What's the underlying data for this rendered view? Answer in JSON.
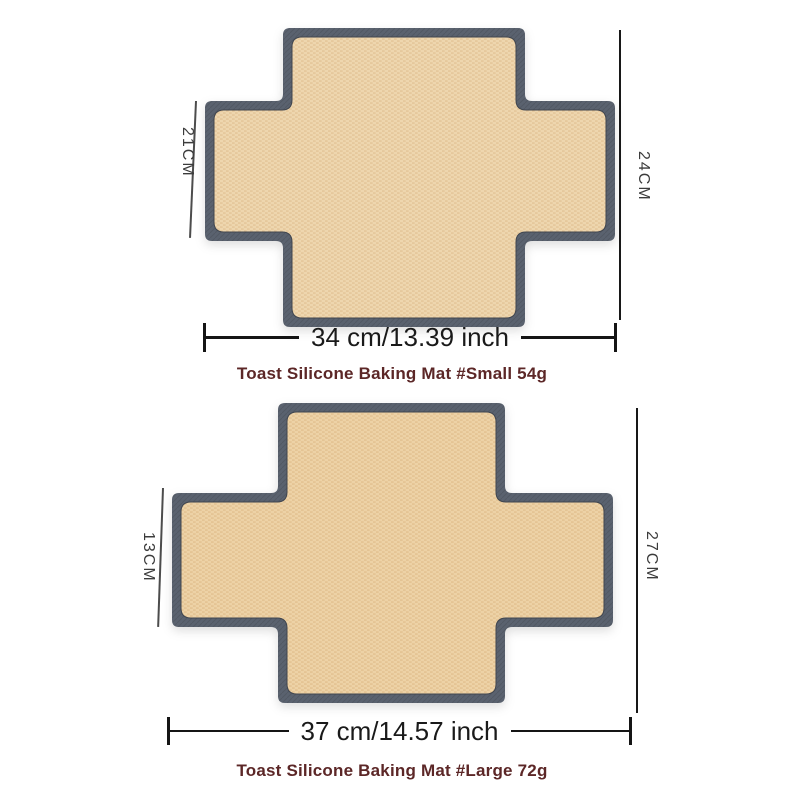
{
  "page": {
    "background_color": "#ffffff",
    "description": "Dimension diagram of two cross-shaped toast silicone baking mats"
  },
  "colors": {
    "mat_border": "#5a626f",
    "mat_surface": "#eed6ae",
    "mat_surface_weave": "#e2c295",
    "caption_text": "#5c2727",
    "dimension_line": "#151515",
    "side_label_text": "#3c3c3c"
  },
  "products": [
    {
      "caption": "Toast Silicone Baking Mat #Small 54g",
      "side_height_label": "21CM",
      "overall_height_label": "24CM",
      "width_label": "34 cm/13.39 inch"
    },
    {
      "caption": "Toast Silicone Baking Mat #Large 72g",
      "side_height_label": "13CM",
      "overall_height_label": "27CM",
      "width_label": "37 cm/14.57 inch"
    }
  ]
}
